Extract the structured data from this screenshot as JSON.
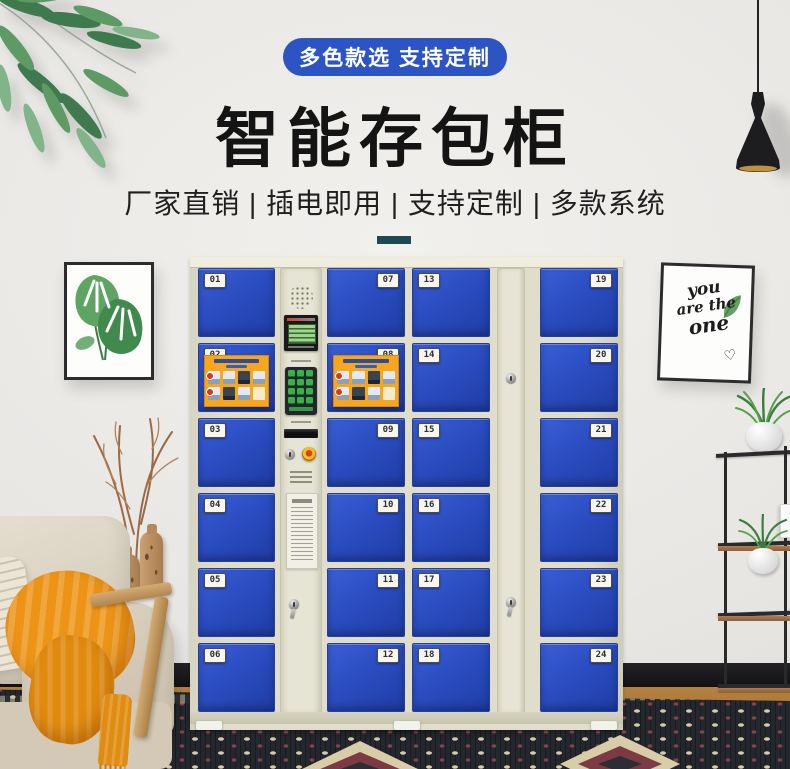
{
  "hero": {
    "badge": "多色款选 支持定制",
    "title": "智能存包柜",
    "subtitle": "厂家直销 | 插电即用 | 支持定制 | 多款系统"
  },
  "locker": {
    "doors_a": [
      "01",
      "02",
      "03",
      "04",
      "05",
      "06"
    ],
    "doors_b": [
      "07",
      "08",
      "09",
      "10",
      "11",
      "12"
    ],
    "doors_c": [
      "13",
      "14",
      "15",
      "16",
      "17",
      "18"
    ],
    "doors_d": [
      "19",
      "20",
      "21",
      "22",
      "23",
      "24"
    ]
  },
  "wall_art": {
    "right_line1": "you",
    "right_line2": "are the",
    "right_line3": "one",
    "right_heart": "♡"
  },
  "colors": {
    "door_blue": "#2a4cc0",
    "cabinet_beige": "#e0ddca",
    "badge_blue": "#2c55c3",
    "divider_teal": "#1d4a52",
    "throw_orange": "#ed9416",
    "keypad_green": "#37b24a",
    "poster_orange": "#f8a61e",
    "carpet_dark": "#24272d"
  }
}
